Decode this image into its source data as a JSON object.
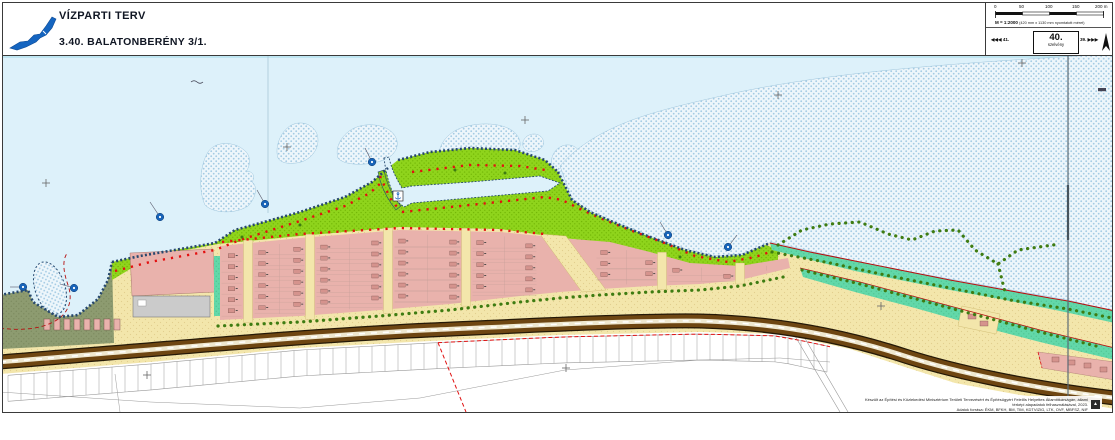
{
  "header": {
    "logo": "balaton-lake-logo",
    "title": "VÍZPARTI TERV",
    "subtitle": "3.40. BALATONBERÉNY 3/1."
  },
  "scale_panel": {
    "bar_ticks": [
      "0",
      "50",
      "100",
      "150",
      "200 m"
    ],
    "scale_text": "M = 1:2000",
    "scale_note": "(420 mm x 1130 mm nyomtatott méret)",
    "prev_sheet": "◀◀◀ 41.",
    "sheet_number": "40.",
    "sheet_word": "szelvény",
    "next_sheet": "39. ▶▶▶",
    "north_arrow": "north-arrow-icon"
  },
  "credits": {
    "line1": "Készült az Építési és Közlekedési Minisztérium Területi Tervezésért és Építésügyért Felelős Helyettes Államtitkárságán, állami térképi alapadatok felhasználásával, 2023.",
    "line2": "Adatok forrása: ÉKM, BFKH, BM, TIM, KDTVIZIG, LTK, OVF, MBFSZ, NIF"
  },
  "map": {
    "colors": {
      "lake_water": "#ddf1fa",
      "reed_bed_dot": "#a4cbe4",
      "waterfront_park_green": "#8fd41c",
      "forest_olive": "#8d9b70",
      "beach_teal": "#62d8a9",
      "resort_parcel_pink": "#e9b2ac",
      "building_pink": "#d5938d",
      "road_beige": "#f3e6ab",
      "main_road_brown": "#6e4612",
      "plan_boundary_red": "#e01010",
      "shore_edge_blue": "#26486e",
      "large_building_gray": "#cbcbcb"
    },
    "symbols": {
      "shore_marker": "blue-circle-marker-icon",
      "harbor": "anchor-icon",
      "survey_cross": "grid-cross-icon"
    }
  }
}
